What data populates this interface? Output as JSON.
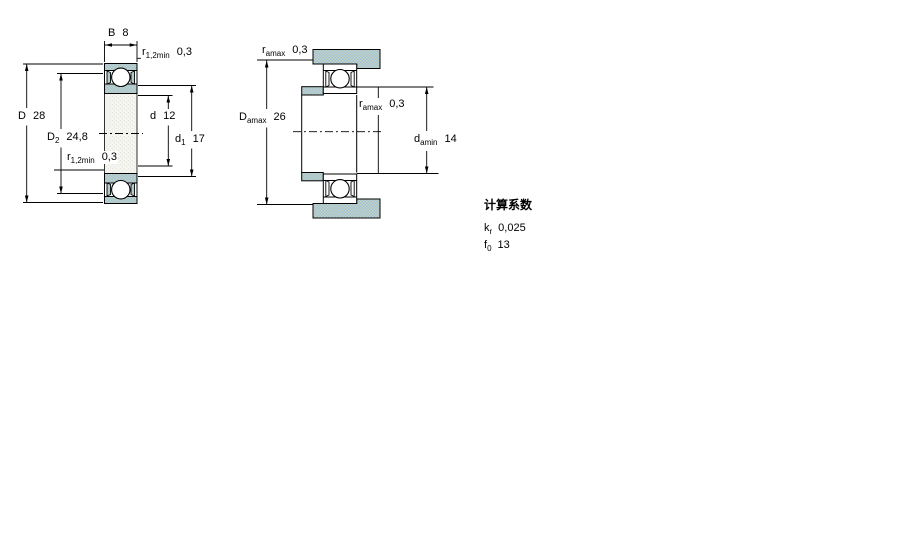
{
  "figure": {
    "type": "bearing-technical-drawing",
    "views": {
      "left": "bearing-cross-section",
      "right": "abutment-dimensions"
    }
  },
  "colors": {
    "line": "#000000",
    "hatch_base": "#9fc1d9",
    "hatch_dot": "#c7d4c0",
    "bore_base": "#f4f4f0",
    "bore_dot": "#e6e6dd",
    "white": "#ffffff"
  },
  "left_view": {
    "labels": {
      "B": {
        "sym": "B",
        "sub": "",
        "val": "8"
      },
      "r_top": {
        "sym": "r",
        "sub": "1,2min",
        "val": "0,3"
      },
      "D": {
        "sym": "D",
        "sub": "",
        "val": "28"
      },
      "D2": {
        "sym": "D",
        "sub": "2",
        "val": "24,8"
      },
      "r_bottom": {
        "sym": "r",
        "sub": "1,2min",
        "val": "0,3"
      },
      "d": {
        "sym": "d",
        "sub": "",
        "val": "12"
      },
      "d1": {
        "sym": "d",
        "sub": "1",
        "val": "17"
      }
    }
  },
  "right_view": {
    "labels": {
      "ra_top": {
        "sym": "r",
        "sub": "amax",
        "val": "0,3"
      },
      "Da": {
        "sym": "D",
        "sub": "amax",
        "val": "26"
      },
      "ra_mid": {
        "sym": "r",
        "sub": "amax",
        "val": "0,3"
      },
      "da": {
        "sym": "d",
        "sub": "amin",
        "val": "14"
      }
    }
  },
  "calculation_factors": {
    "title": "计算系数",
    "rows": [
      {
        "sym": "k",
        "sub": "r",
        "val": "0,025"
      },
      {
        "sym": "f",
        "sub": "0",
        "val": "13"
      }
    ]
  }
}
